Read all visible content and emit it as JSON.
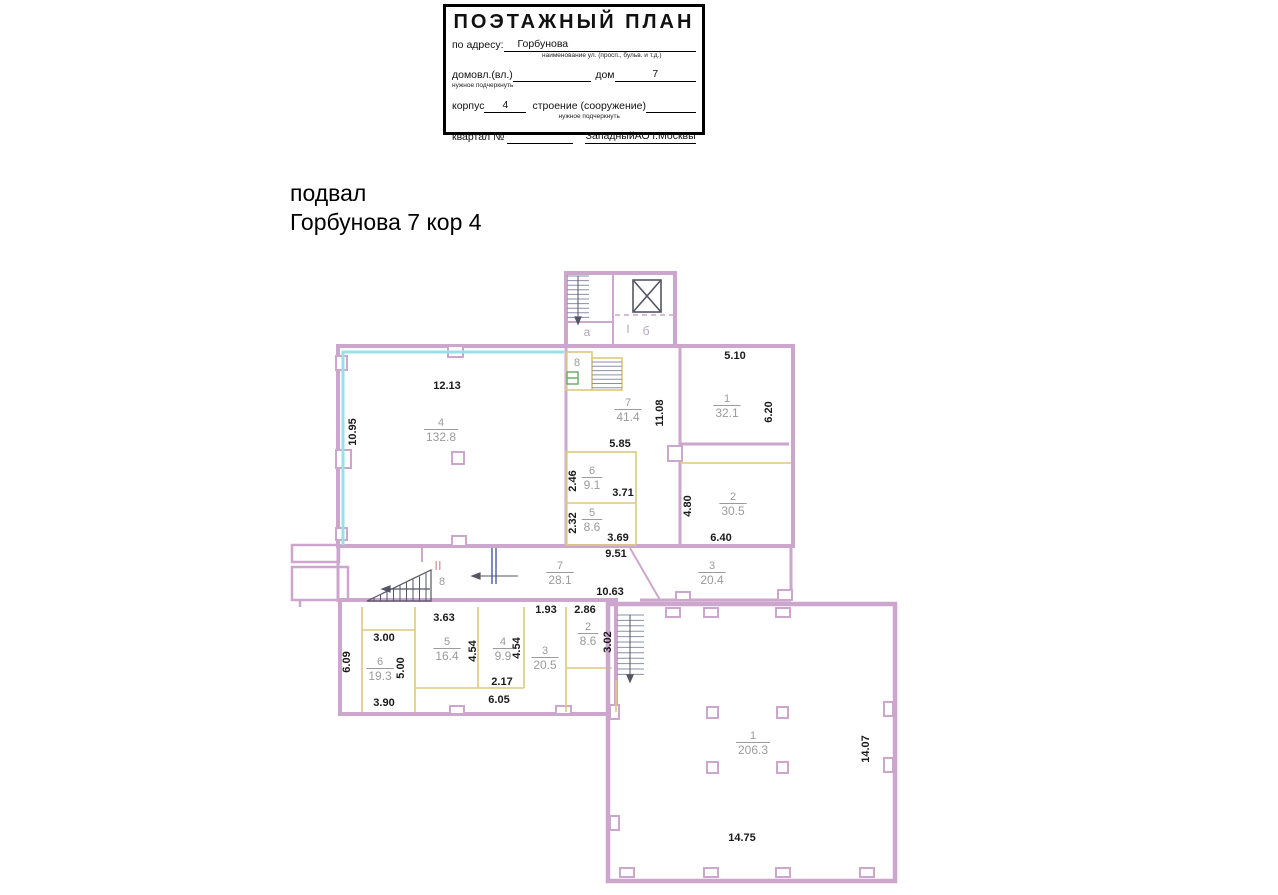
{
  "title_block": {
    "title": "ПОЭТАЖНЫЙ ПЛАН",
    "address_label": "по адресу:",
    "address_value": "Горбунова",
    "address_hint": "наименование ул. (просп., бульв. и т.д.)",
    "line2": {
      "label1": "домовл.(вл.)",
      "hint": "нужное подчеркнуть",
      "label2": "дом",
      "value2": "7"
    },
    "line3": {
      "label1": "корпус",
      "value1": "4",
      "label2": "строение (сооружение)",
      "hint": "нужное подчеркнуть"
    },
    "line4": {
      "label": "квартал №",
      "value": "ЗападныйАО г.Москвы"
    }
  },
  "heading": {
    "line1": "подвал",
    "line2": "Горбунова 7 кор 4"
  },
  "plan": {
    "colors": {
      "wall": "#cda6cd",
      "partition": "#ddc87e",
      "cyan": "#9adfe9",
      "dark": "#555566",
      "stair": "#8890a8",
      "green": "#6fae6f",
      "blue": "#3b4aa0",
      "dim_text": "#1a1a1a",
      "room_text": "#9b9b9b",
      "red_label": "#dd8a8a"
    },
    "rooms": [
      {
        "n": "4",
        "a": "132.8",
        "x": 441,
        "y": 426
      },
      {
        "n": "7",
        "a": "41.4",
        "x": 628,
        "y": 406
      },
      {
        "n": "1",
        "a": "32.1",
        "x": 727,
        "y": 402
      },
      {
        "n": "6",
        "a": "9.1",
        "x": 592,
        "y": 474
      },
      {
        "n": "5",
        "a": "8.6",
        "x": 592,
        "y": 516
      },
      {
        "n": "2",
        "a": "30.5",
        "x": 733,
        "y": 500
      },
      {
        "n": "7",
        "a": "28.1",
        "x": 560,
        "y": 569
      },
      {
        "n": "3",
        "a": "20.4",
        "x": 712,
        "y": 569
      },
      {
        "n": "6",
        "a": "19.3",
        "x": 380,
        "y": 665
      },
      {
        "n": "5",
        "a": "16.4",
        "x": 447,
        "y": 645
      },
      {
        "n": "4",
        "a": "9.9",
        "x": 503,
        "y": 645
      },
      {
        "n": "3",
        "a": "20.5",
        "x": 545,
        "y": 654
      },
      {
        "n": "2",
        "a": "8.6",
        "x": 588,
        "y": 630
      },
      {
        "n": "1",
        "a": "206.3",
        "x": 753,
        "y": 739
      }
    ],
    "dims": [
      {
        "t": "12.13",
        "x": 447,
        "y": 389
      },
      {
        "t": "10.95",
        "x": 356,
        "y": 432,
        "r": -90
      },
      {
        "t": "5.10",
        "x": 735,
        "y": 359
      },
      {
        "t": "6.20",
        "x": 772,
        "y": 412,
        "r": -90
      },
      {
        "t": "11.08",
        "x": 663,
        "y": 413,
        "r": -90
      },
      {
        "t": "5.85",
        "x": 620,
        "y": 447
      },
      {
        "t": "2.46",
        "x": 576,
        "y": 481,
        "r": -90
      },
      {
        "t": "3.71",
        "x": 623,
        "y": 496
      },
      {
        "t": "2.32",
        "x": 576,
        "y": 523,
        "r": -90
      },
      {
        "t": "3.69",
        "x": 618,
        "y": 541
      },
      {
        "t": "4.80",
        "x": 691,
        "y": 506,
        "r": -90
      },
      {
        "t": "6.40",
        "x": 721,
        "y": 541
      },
      {
        "t": "9.51",
        "x": 616,
        "y": 557
      },
      {
        "t": "10.63",
        "x": 610,
        "y": 595
      },
      {
        "t": "1.93",
        "x": 546,
        "y": 613
      },
      {
        "t": "2.86",
        "x": 585,
        "y": 613
      },
      {
        "t": "3.63",
        "x": 444,
        "y": 621
      },
      {
        "t": "3.00",
        "x": 384,
        "y": 641
      },
      {
        "t": "6.09",
        "x": 350,
        "y": 662,
        "r": -90
      },
      {
        "t": "5.00",
        "x": 404,
        "y": 668,
        "r": -90
      },
      {
        "t": "4.54",
        "x": 476,
        "y": 651,
        "r": -90
      },
      {
        "t": "4.54",
        "x": 520,
        "y": 648,
        "r": -90
      },
      {
        "t": "2.17",
        "x": 502,
        "y": 685
      },
      {
        "t": "6.05",
        "x": 499,
        "y": 703
      },
      {
        "t": "3.90",
        "x": 384,
        "y": 706
      },
      {
        "t": "3.02",
        "x": 611,
        "y": 642,
        "r": -90
      },
      {
        "t": "14.07",
        "x": 869,
        "y": 749,
        "r": -90
      },
      {
        "t": "14.75",
        "x": 742,
        "y": 841
      }
    ],
    "labels": [
      {
        "t": "8",
        "x": 577,
        "y": 366,
        "cls": "rnum",
        "name": "room-8-label"
      },
      {
        "t": "а",
        "x": 587,
        "y": 336,
        "cls": "misc",
        "name": "stair-section-a-label"
      },
      {
        "t": "I",
        "x": 628,
        "y": 333,
        "cls": "misc",
        "name": "section-I-label"
      },
      {
        "t": "б",
        "x": 646,
        "y": 335,
        "cls": "misc",
        "name": "section-b-label"
      },
      {
        "t": "II",
        "x": 438,
        "y": 570,
        "cls": "redlbl",
        "name": "section-II-label"
      },
      {
        "t": "8",
        "x": 442,
        "y": 585,
        "cls": "rnum",
        "name": "section-II-area-label"
      }
    ]
  }
}
